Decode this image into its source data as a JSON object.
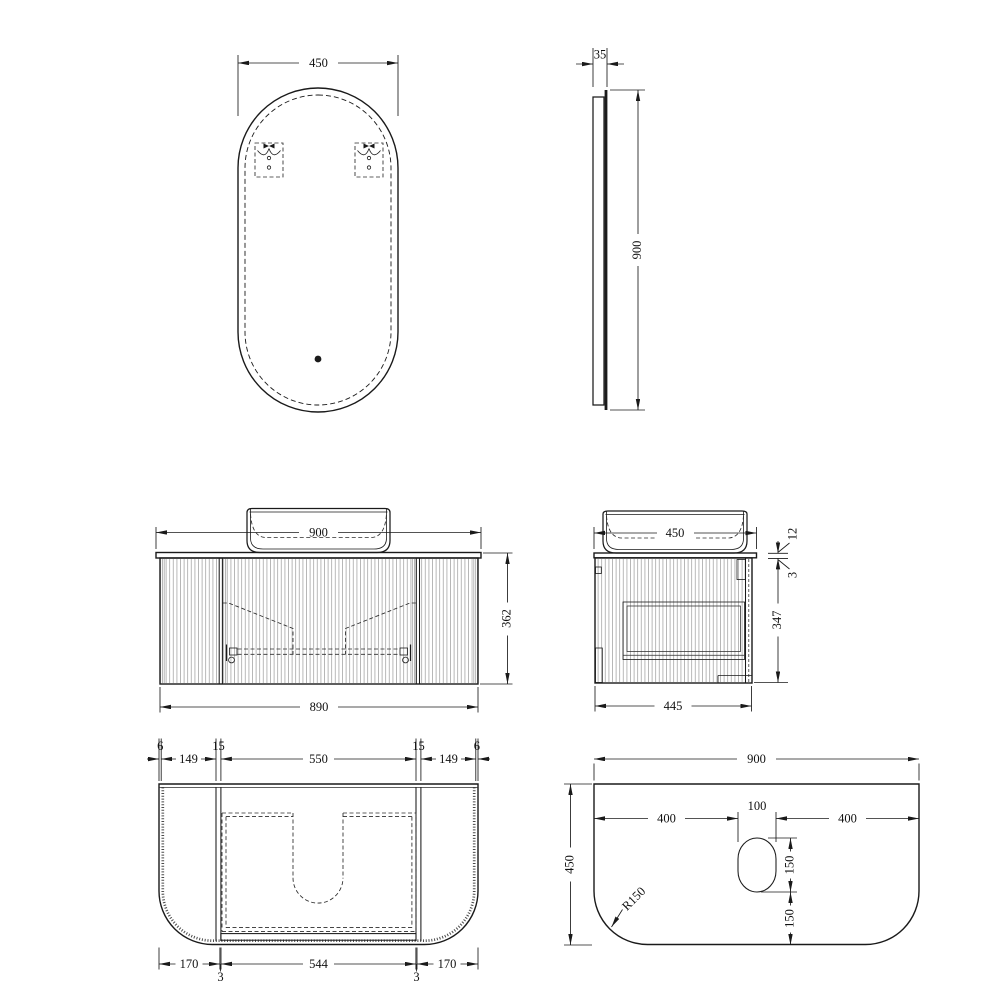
{
  "colors": {
    "line": "#1a1a1a",
    "glass": "#1c1c1c",
    "background": "#ffffff",
    "flute": "#7d7d7d"
  },
  "views": {
    "mirror_front": {
      "width": "450"
    },
    "mirror_side": {
      "depth": "35",
      "height": "900"
    },
    "vanity_front": {
      "counter_width": "900",
      "total_height": "362",
      "cabinet_width": "890"
    },
    "vanity_side": {
      "counter_depth": "450",
      "counter_thickness": "12",
      "gap": "3",
      "cabinet_height": "347",
      "cabinet_depth": "445"
    },
    "cabinet_plan": {
      "top_chain": [
        "6",
        "149",
        "15",
        "550",
        "15",
        "149",
        "6"
      ],
      "bottom_chain": [
        "170",
        "3",
        "544",
        "3",
        "170"
      ]
    },
    "counter_plan": {
      "width": "900",
      "top_chain": [
        "400",
        "100",
        "400"
      ],
      "depth": "450",
      "right_chain": [
        "150",
        "150"
      ],
      "corner_radius": "R150"
    }
  }
}
